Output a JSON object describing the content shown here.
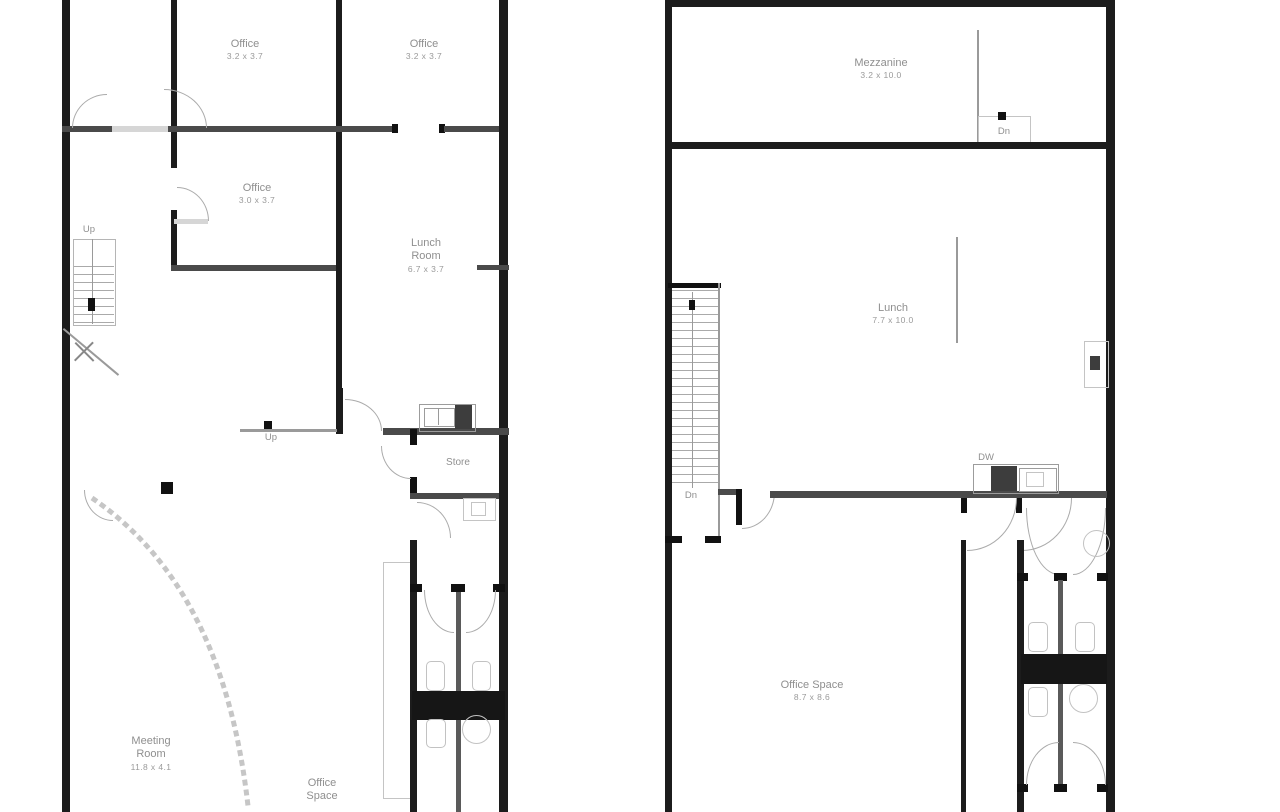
{
  "palette": {
    "outer_wall": "#1c1c1c",
    "interior_wall": "#4a4a4a",
    "desk_block": "#161616",
    "fixture_outline": "#9c9c9c",
    "light_outline": "#c4c4c4",
    "label_text": "#8f8f8f"
  },
  "left_plan": {
    "rooms": [
      {
        "name": "Office",
        "dims": "3.2 x 3.7"
      },
      {
        "name": "Office",
        "dims": "3.2 x 3.7"
      },
      {
        "name": "Office",
        "dims": "3.0 x 3.7"
      },
      {
        "name": "Lunch Room",
        "dims": "6.7 x 3.7"
      },
      {
        "name": "Store"
      },
      {
        "name": "Meeting Room",
        "dims": "11.8 x 4.1"
      },
      {
        "name": "Office Space"
      }
    ],
    "annotations": {
      "stairs_up": "Up",
      "mid_up": "Up"
    }
  },
  "right_plan": {
    "rooms": [
      {
        "name": "Mezzanine",
        "dims": "3.2 x 10.0"
      },
      {
        "name": "Lunch",
        "dims": "7.7 x 10.0"
      },
      {
        "name": "Office Space",
        "dims": "8.7 x 8.6"
      }
    ],
    "annotations": {
      "mezzanine_dn": "Dn",
      "stairs_dn": "Dn",
      "dishwasher": "DW"
    }
  }
}
